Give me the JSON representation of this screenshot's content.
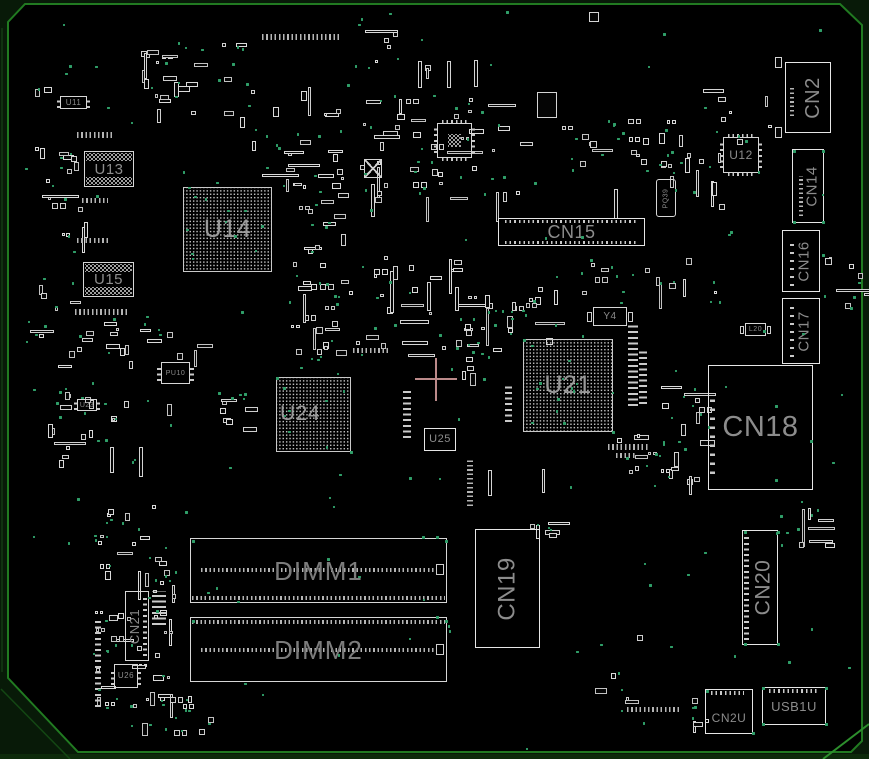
{
  "view": {
    "width": 869,
    "height": 759
  },
  "colors": {
    "background": "#000000",
    "outside": "#081a08",
    "board_border": "#217a21",
    "board_border_bright": "#2d8f2d",
    "component_outline": "#d6d6d6",
    "connector_outline": "#e6e6e6",
    "label_text": "#8c8c8c",
    "dimm_label_text": "#7c7c7c",
    "bga_label_text": "#9a9a9a",
    "test_point": "#2f9e68",
    "crosshair": "#bb8a8a"
  },
  "components": {
    "u11": {
      "label": "U11"
    },
    "u12": {
      "label": "U12"
    },
    "u13": {
      "label": "U13"
    },
    "u14": {
      "label": "U14"
    },
    "u15": {
      "label": "U15"
    },
    "u21": {
      "label": "U21"
    },
    "u23": {
      "label": "U23"
    },
    "u24": {
      "label": "U24"
    },
    "u25": {
      "label": "U25"
    },
    "u26": {
      "label": "U26"
    },
    "pu10": {
      "label": "PU10"
    },
    "pq39": {
      "label": "PQ39"
    },
    "y4": {
      "label": "Y4"
    },
    "l20": {
      "label": "L20"
    },
    "cn2": {
      "label": "CN2"
    },
    "cn14": {
      "label": "CN14"
    },
    "cn15": {
      "label": "CN15"
    },
    "cn16": {
      "label": "CN16"
    },
    "cn17": {
      "label": "CN17"
    },
    "cn18": {
      "label": "CN18"
    },
    "cn19": {
      "label": "CN19"
    },
    "cn20": {
      "label": "CN20"
    },
    "cn21": {
      "label": "CN21"
    },
    "cn2u": {
      "label": "CN2U"
    },
    "usb1u": {
      "label": "USB1U"
    },
    "dimm1": {
      "label": "DIMM1"
    },
    "dimm2": {
      "label": "DIMM2"
    }
  }
}
